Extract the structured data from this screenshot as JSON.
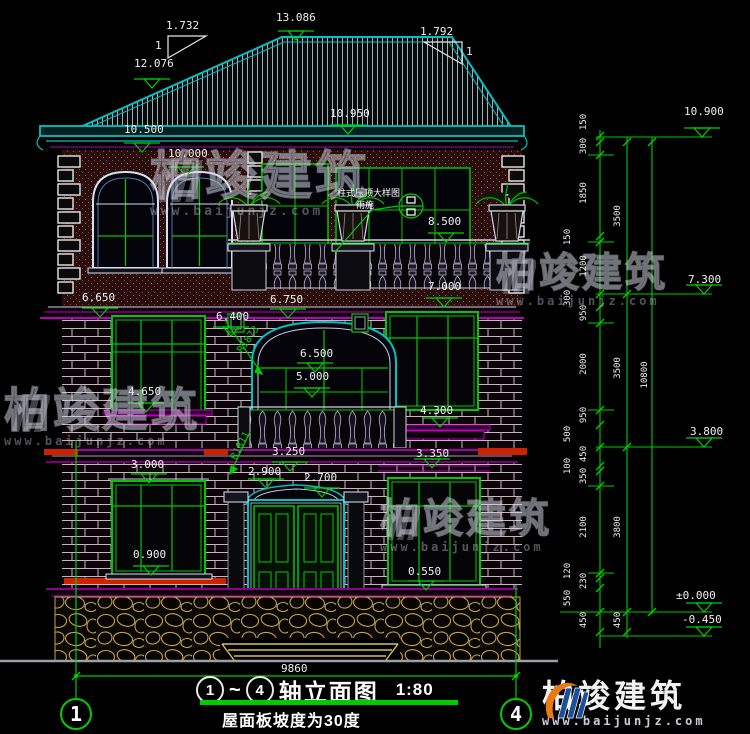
{
  "title": {
    "axis_from": "1",
    "tilde": "~",
    "axis_to": "4",
    "text": "轴立面图",
    "scale": "1:80",
    "subtitle": "屋面板坡度为30度"
  },
  "watermark": {
    "name": "柏竣建筑",
    "url": "www.baijunjz.com"
  },
  "callout": {
    "line1": "柱式压顶大样图",
    "line2": "雨施"
  },
  "slopes": {
    "left_run": "1.732",
    "left_rise": "1",
    "right_run": "1.792",
    "right_rise": "1"
  },
  "radii": {
    "upper": "R1873",
    "lower": "R1811"
  },
  "elevations": [
    "13.086",
    "12.076",
    "10.500",
    "10.000",
    "10.950",
    "8.500",
    "7.000",
    "6.750",
    "6.650",
    "6.400",
    "6.500",
    "5.000",
    "4.650",
    "4.300",
    "3.250",
    "3.350",
    "3.000",
    "2.900",
    "2.700",
    "0.900",
    "0.550",
    "10.900",
    "7.300",
    "3.800",
    "±0.000",
    "-0.450"
  ],
  "dims_inner": [
    "150",
    "300",
    "1850",
    "150",
    "1200",
    "300",
    "950",
    "2000",
    "950",
    "500",
    "450",
    "100",
    "350",
    "2100",
    "120",
    "230",
    "550",
    "450"
  ],
  "dims_storey": [
    "3500",
    "3500",
    "3800",
    "450"
  ],
  "dim_total": "10800",
  "dim_width": "9860",
  "axes": [
    "1",
    "4"
  ],
  "colors": {
    "line_teal": "#00c2c2",
    "line_green": "#00cc00",
    "line_magenta": "#bb00bb",
    "accent_red": "#cc2200",
    "stone_tan": "#c8a04a"
  }
}
